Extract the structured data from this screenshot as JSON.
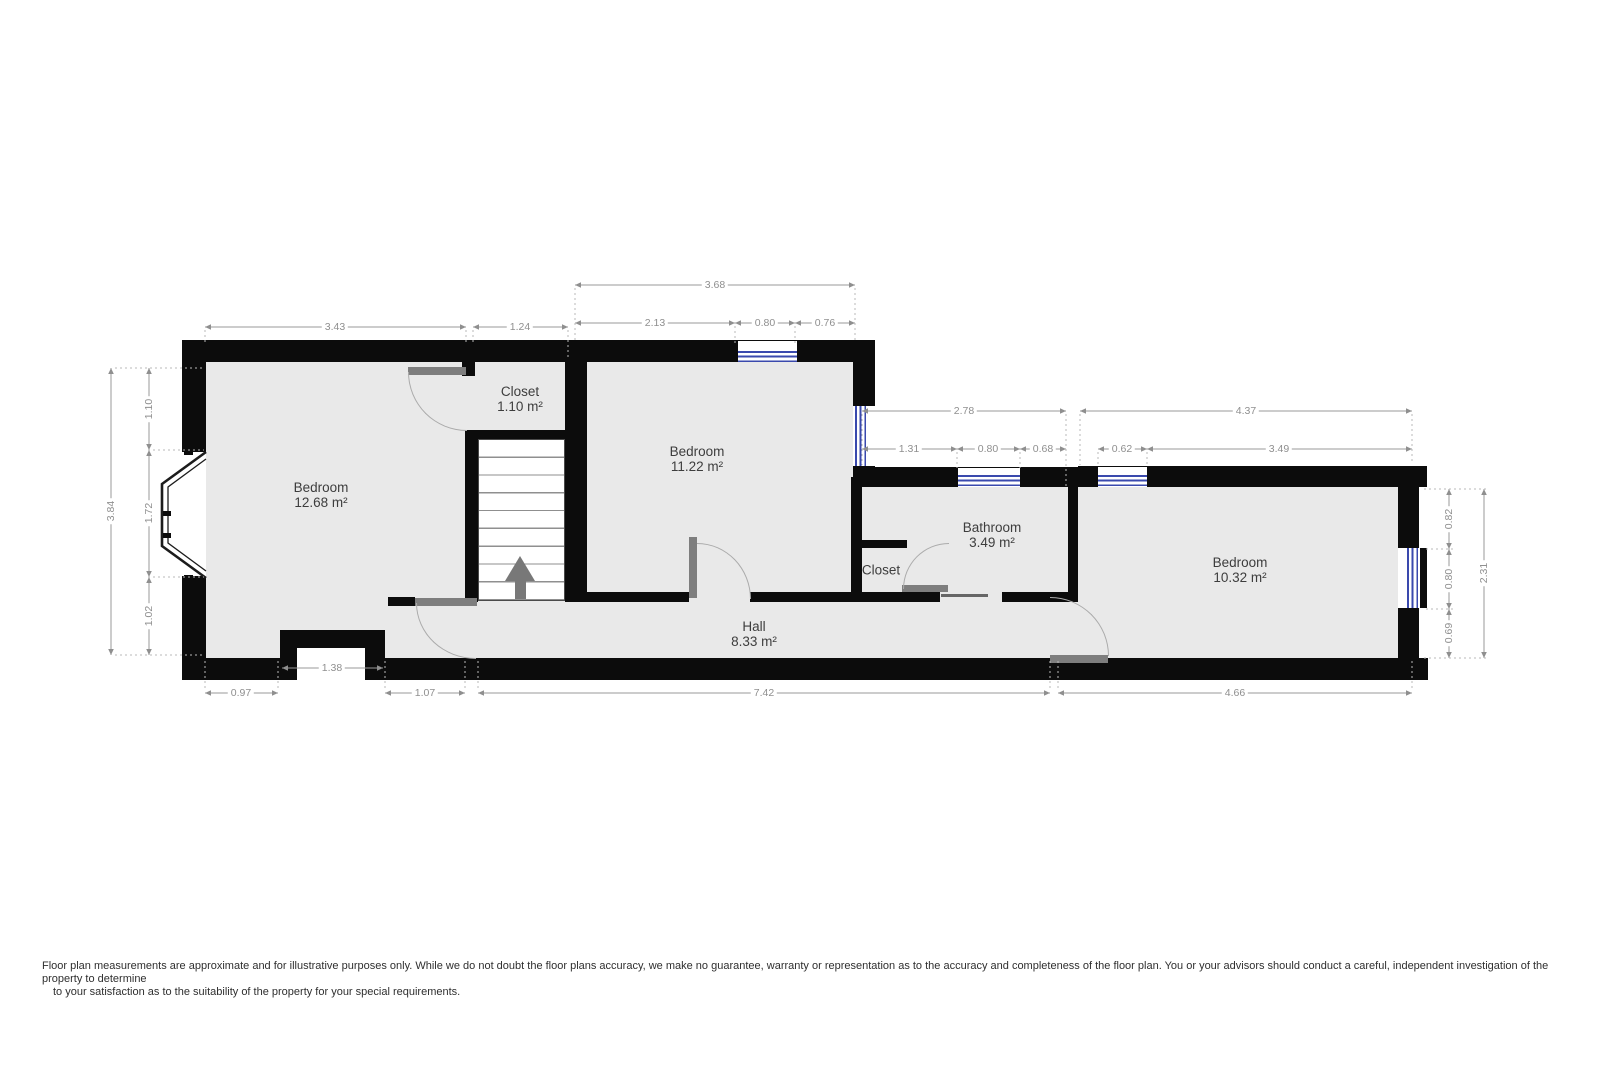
{
  "rooms": {
    "bedroom_left": {
      "name": "Bedroom",
      "area": "12.68 m²"
    },
    "closet_top": {
      "name": "Closet",
      "area": "1.10 m²"
    },
    "bedroom_mid": {
      "name": "Bedroom",
      "area": "11.22 m²"
    },
    "bathroom": {
      "name": "Bathroom",
      "area": "3.49 m²"
    },
    "closet_bath": {
      "name": "Closet"
    },
    "hall": {
      "name": "Hall",
      "area": "8.33 m²"
    },
    "bedroom_right": {
      "name": "Bedroom",
      "area": "10.32 m²"
    }
  },
  "dims": {
    "top_left": "3.43",
    "top_closet": "1.24",
    "top_total": "3.68",
    "top_a": "2.13",
    "top_win": "0.80",
    "top_b": "0.76",
    "bath_total": "2.78",
    "bath_a": "1.31",
    "bath_win": "0.80",
    "bath_b": "0.68",
    "ne_total": "4.37",
    "ne_win": "0.62",
    "ne_a": "3.49",
    "right_a": "0.82",
    "right_win": "0.80",
    "right_b": "0.69",
    "right_total": "2.31",
    "left_a": "1.10",
    "left_bay": "1.72",
    "left_b": "1.02",
    "left_total": "3.84",
    "bottom_a": "0.97",
    "bottom_niche": "1.38",
    "bottom_b": "1.07",
    "bottom_hall": "7.42",
    "bottom_e": "4.66"
  },
  "colors": {
    "wall": "#0c0c0c",
    "floor": "#e9e9e9",
    "window": "#3a49ad",
    "door": "#7e7e7e",
    "dim_text": "#8f8f8f"
  },
  "disclaimer": {
    "line1": "Floor plan measurements are approximate and for illustrative purposes only. While we do not doubt the floor plans accuracy, we make no guarantee, warranty or representation as to the accuracy and completeness of the floor plan. You or your advisors should conduct a careful, independent investigation of the",
    "line2": "property to determine",
    "line3": "to your satisfaction as to the suitability of the property for your special requirements."
  }
}
